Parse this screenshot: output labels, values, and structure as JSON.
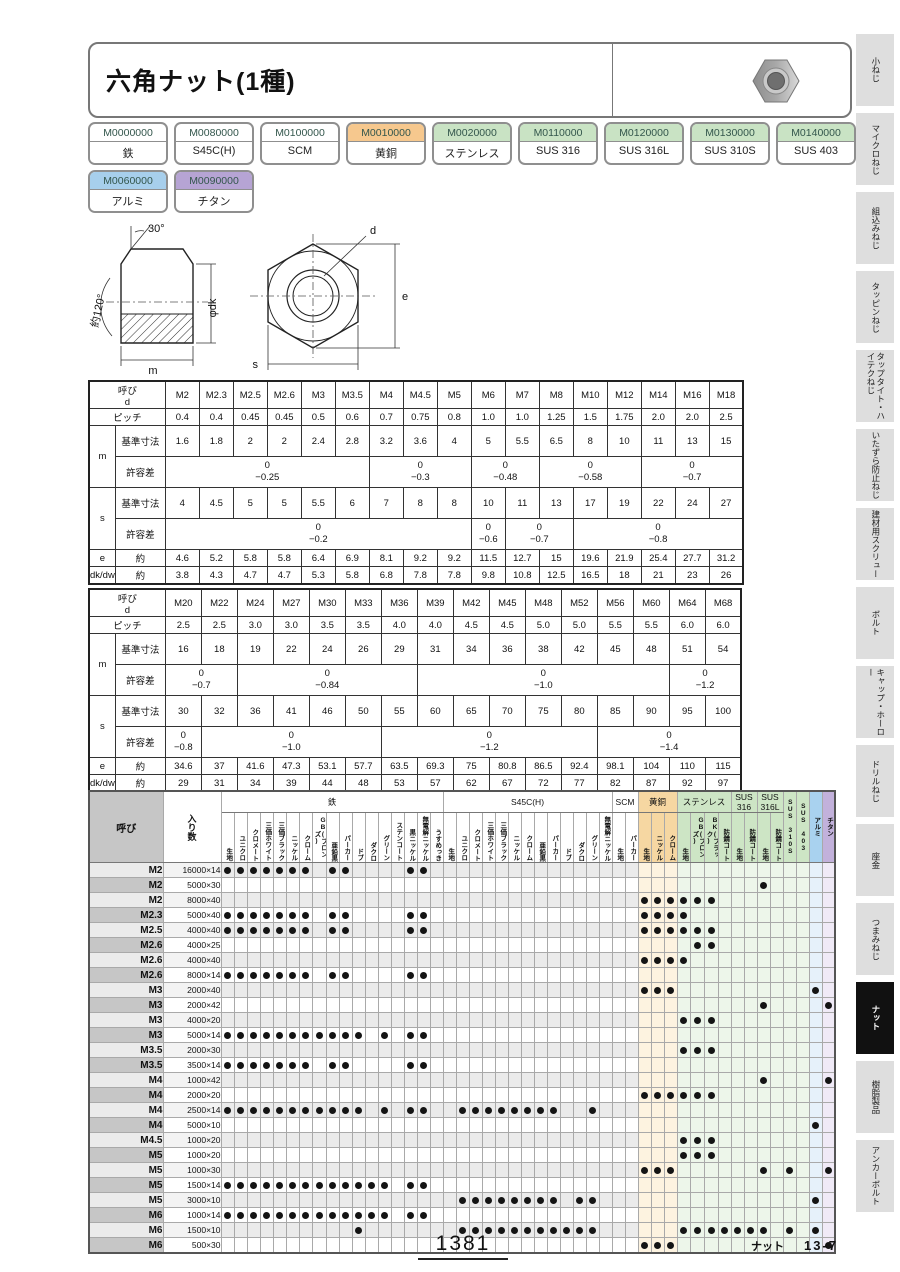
{
  "page": {
    "title": "六角ナット(1種)",
    "page_number": "1381",
    "footer_category": "ナット",
    "footer_ref": "13-7"
  },
  "chips": [
    {
      "code": "M0000000",
      "label": "鉄",
      "color": "white"
    },
    {
      "code": "M0080000",
      "label": "S45C(H)",
      "color": "white"
    },
    {
      "code": "M0100000",
      "label": "SCM",
      "color": "white"
    },
    {
      "code": "M0010000",
      "label": "黄銅",
      "color": "orange"
    },
    {
      "code": "M0020000",
      "label": "ステンレス",
      "color": "green"
    },
    {
      "code": "M0110000",
      "label": "SUS 316",
      "color": "green"
    },
    {
      "code": "M0120000",
      "label": "SUS 316L",
      "color": "green"
    },
    {
      "code": "M0130000",
      "label": "SUS 310S",
      "color": "green"
    },
    {
      "code": "M0140000",
      "label": "SUS 403",
      "color": "green"
    },
    {
      "code": "M0060000",
      "label": "アルミ",
      "color": "blue"
    },
    {
      "code": "M0090000",
      "label": "チタン",
      "color": "purple"
    }
  ],
  "drawing": {
    "labels": {
      "angle_top": "30°",
      "angle_left": "約120°",
      "m": "m",
      "dk": "φdk",
      "d": "d",
      "e": "e",
      "s": "s"
    }
  },
  "dim_labels": {
    "head": "呼び",
    "head_sub": "d",
    "pitch": "ピッチ",
    "m": "m",
    "s": "s",
    "basic": "基準寸法",
    "tol": "許容差",
    "e": "e",
    "dk": "dk/dw",
    "approx": "約"
  },
  "dim_tables": [
    {
      "cols": [
        "M2",
        "M2.3",
        "M2.5",
        "M2.6",
        "M3",
        "M3.5",
        "M4",
        "M4.5",
        "M5",
        "M6",
        "M7",
        "M8",
        "M10",
        "M12",
        "M14",
        "M16",
        "M18"
      ],
      "pitch": [
        "0.4",
        "0.4",
        "0.45",
        "0.45",
        "0.5",
        "0.6",
        "0.7",
        "0.75",
        "0.8",
        "1.0",
        "1.0",
        "1.25",
        "1.5",
        "1.75",
        "2.0",
        "2.0",
        "2.5"
      ],
      "m_basic": [
        "1.6",
        "1.8",
        "2",
        "2",
        "2.4",
        "2.8",
        "3.2",
        "3.6",
        "4",
        "5",
        "5.5",
        "6.5",
        "8",
        "10",
        "11",
        "13",
        "15"
      ],
      "m_tol": [
        {
          "top": "0",
          "bottom": "−0.25",
          "span": 6
        },
        {
          "top": "0",
          "bottom": "−0.3",
          "span": 3
        },
        {
          "top": "0",
          "bottom": "−0.48",
          "span": 2
        },
        {
          "top": "0",
          "bottom": "−0.58",
          "span": 3
        },
        {
          "top": "0",
          "bottom": "−0.7",
          "span": 3
        }
      ],
      "s_basic": [
        "4",
        "4.5",
        "5",
        "5",
        "5.5",
        "6",
        "7",
        "8",
        "8",
        "10",
        "11",
        "13",
        "17",
        "19",
        "22",
        "24",
        "27"
      ],
      "s_tol": [
        {
          "top": "0",
          "bottom": "−0.2",
          "span": 9
        },
        {
          "top": "0",
          "bottom": "−0.6",
          "span": 1
        },
        {
          "top": "0",
          "bottom": "−0.7",
          "span": 2
        },
        {
          "top": "0",
          "bottom": "−0.8",
          "span": 5
        }
      ],
      "e": [
        "4.6",
        "5.2",
        "5.8",
        "5.8",
        "6.4",
        "6.9",
        "8.1",
        "9.2",
        "9.2",
        "11.5",
        "12.7",
        "15",
        "19.6",
        "21.9",
        "25.4",
        "27.7",
        "31.2"
      ],
      "dk": [
        "3.8",
        "4.3",
        "4.7",
        "4.7",
        "5.3",
        "5.8",
        "6.8",
        "7.8",
        "7.8",
        "9.8",
        "10.8",
        "12.5",
        "16.5",
        "18",
        "21",
        "23",
        "26"
      ]
    },
    {
      "cols": [
        "M20",
        "M22",
        "M24",
        "M27",
        "M30",
        "M33",
        "M36",
        "M39",
        "M42",
        "M45",
        "M48",
        "M52",
        "M56",
        "M60",
        "M64",
        "M68"
      ],
      "pitch": [
        "2.5",
        "2.5",
        "3.0",
        "3.0",
        "3.5",
        "3.5",
        "4.0",
        "4.0",
        "4.5",
        "4.5",
        "5.0",
        "5.0",
        "5.5",
        "5.5",
        "6.0",
        "6.0"
      ],
      "m_basic": [
        "16",
        "18",
        "19",
        "22",
        "24",
        "26",
        "29",
        "31",
        "34",
        "36",
        "38",
        "42",
        "45",
        "48",
        "51",
        "54"
      ],
      "m_tol": [
        {
          "top": "0",
          "bottom": "−0.7",
          "span": 2
        },
        {
          "top": "0",
          "bottom": "−0.84",
          "span": 5
        },
        {
          "top": "0",
          "bottom": "−1.0",
          "span": 7
        },
        {
          "top": "0",
          "bottom": "−1.2",
          "span": 2
        }
      ],
      "s_basic": [
        "30",
        "32",
        "36",
        "41",
        "46",
        "50",
        "55",
        "60",
        "65",
        "70",
        "75",
        "80",
        "85",
        "90",
        "95",
        "100"
      ],
      "s_tol": [
        {
          "top": "0",
          "bottom": "−0.8",
          "span": 1
        },
        {
          "top": "0",
          "bottom": "−1.0",
          "span": 5
        },
        {
          "top": "0",
          "bottom": "−1.2",
          "span": 6
        },
        {
          "top": "0",
          "bottom": "−1.4",
          "span": 4
        }
      ],
      "e": [
        "34.6",
        "37",
        "41.6",
        "47.3",
        "53.1",
        "57.7",
        "63.5",
        "69.3",
        "75",
        "80.8",
        "86.5",
        "92.4",
        "98.1",
        "104",
        "110",
        "115"
      ],
      "dk": [
        "29",
        "31",
        "34",
        "39",
        "44",
        "48",
        "53",
        "57",
        "62",
        "67",
        "72",
        "77",
        "82",
        "87",
        "92",
        "97"
      ]
    }
  ],
  "matrix": {
    "size_header": "呼び",
    "qty_header": "入り数",
    "groups": [
      {
        "label": "鉄",
        "tint": "iron",
        "cols": [
          "生地",
          "ユニクロ",
          "クロメート",
          "三価ホワイト",
          "三価ブラック",
          "ニッケル",
          "クローム",
          "GB(ブロンズ)",
          "亜鉛黒",
          "パーカー",
          "ドブ",
          "ダクロ",
          "グリーン",
          "ステンコート",
          "黒ニッケル",
          "無電解ニッケル",
          "うすめっき"
        ]
      },
      {
        "label": "S45C(H)",
        "tint": "iron",
        "cols": [
          "生地",
          "ユニクロ",
          "クロメート",
          "三価ホワイト",
          "三価ブラック",
          "ニッケル",
          "クローム",
          "亜鉛黒",
          "パーカー",
          "ドブ",
          "ダクロ",
          "グリーン",
          "無電解ニッケル"
        ]
      },
      {
        "label": "SCM",
        "tint": "iron",
        "cols": [
          "生地",
          "パーカー"
        ]
      },
      {
        "label": "黄銅",
        "tint": "brass",
        "cols": [
          "生地",
          "ニッケル",
          "クローム"
        ]
      },
      {
        "label": "ステンレス",
        "tint": "sus",
        "cols": [
          "生地",
          "GB(ブロンズ)",
          "BK(ブラック)",
          "防錆コート"
        ]
      },
      {
        "label": "SUS 316",
        "tint": "sus",
        "cols": [
          "生地",
          "防錆コート"
        ]
      },
      {
        "label": "SUS 316L",
        "tint": "sus",
        "cols": [
          "生地",
          "防錆コート"
        ]
      },
      {
        "label": "SUS 310S",
        "tint": "sus",
        "cols": []
      },
      {
        "label": "SUS 403",
        "tint": "sus",
        "cols": []
      },
      {
        "label": "アルミ",
        "tint": "alm",
        "cols": []
      },
      {
        "label": "チタン",
        "tint": "tit",
        "cols": []
      }
    ],
    "rows": [
      {
        "size": "M2",
        "qty": "16000×14",
        "dots": [
          1,
          2,
          3,
          4,
          5,
          6,
          7,
          9,
          10,
          15,
          16
        ]
      },
      {
        "size": "M2",
        "qty": "5000×30",
        "dots": [
          42
        ]
      },
      {
        "size": "M2",
        "qty": "8000×40",
        "dots": [
          33,
          34,
          35,
          36,
          37,
          38
        ]
      },
      {
        "size": "M2.3",
        "qty": "5000×40",
        "dots": [
          1,
          2,
          3,
          4,
          5,
          6,
          7,
          9,
          10,
          15,
          16,
          33,
          34,
          35,
          36
        ]
      },
      {
        "size": "M2.5",
        "qty": "4000×40",
        "dots": [
          1,
          2,
          3,
          4,
          5,
          6,
          7,
          9,
          10,
          15,
          16,
          33,
          34,
          35,
          36,
          37,
          38
        ]
      },
      {
        "size": "M2.6",
        "qty": "4000×25",
        "dots": [
          37,
          38
        ]
      },
      {
        "size": "M2.6",
        "qty": "4000×40",
        "dots": [
          33,
          34,
          35,
          36
        ]
      },
      {
        "size": "M2.6",
        "qty": "8000×14",
        "dots": [
          1,
          2,
          3,
          4,
          5,
          6,
          7,
          9,
          10,
          15,
          16
        ]
      },
      {
        "size": "M3",
        "qty": "2000×40",
        "dots": [
          33,
          34,
          35,
          46
        ]
      },
      {
        "size": "M3",
        "qty": "2000×42",
        "dots": [
          42,
          47
        ]
      },
      {
        "size": "M3",
        "qty": "4000×20",
        "dots": [
          36,
          37,
          38
        ]
      },
      {
        "size": "M3",
        "qty": "5000×14",
        "dots": [
          1,
          2,
          3,
          4,
          5,
          6,
          7,
          8,
          9,
          10,
          11,
          13,
          15,
          16
        ]
      },
      {
        "size": "M3.5",
        "qty": "2000×30",
        "dots": [
          36,
          37,
          38
        ]
      },
      {
        "size": "M3.5",
        "qty": "3500×14",
        "dots": [
          1,
          2,
          3,
          4,
          5,
          6,
          7,
          9,
          10,
          15,
          16
        ]
      },
      {
        "size": "M4",
        "qty": "1000×42",
        "dots": [
          42,
          47
        ]
      },
      {
        "size": "M4",
        "qty": "2000×20",
        "dots": [
          33,
          34,
          35,
          36,
          37,
          38
        ]
      },
      {
        "size": "M4",
        "qty": "2500×14",
        "dots": [
          1,
          2,
          3,
          4,
          5,
          6,
          7,
          8,
          9,
          10,
          11,
          13,
          15,
          16,
          19,
          20,
          21,
          22,
          23,
          24,
          25,
          26,
          29
        ]
      },
      {
        "size": "M4",
        "qty": "5000×10",
        "dots": [
          46
        ]
      },
      {
        "size": "M4.5",
        "qty": "1000×20",
        "dots": [
          36,
          37,
          38
        ]
      },
      {
        "size": "M5",
        "qty": "1000×20",
        "dots": [
          36,
          37,
          38
        ]
      },
      {
        "size": "M5",
        "qty": "1000×30",
        "dots": [
          33,
          34,
          35,
          42,
          44,
          47
        ]
      },
      {
        "size": "M5",
        "qty": "1500×14",
        "dots": [
          1,
          2,
          3,
          4,
          5,
          6,
          7,
          8,
          9,
          10,
          11,
          12,
          13,
          15,
          16
        ]
      },
      {
        "size": "M5",
        "qty": "3000×10",
        "dots": [
          19,
          20,
          21,
          22,
          23,
          24,
          25,
          26,
          28,
          29,
          46
        ]
      },
      {
        "size": "M6",
        "qty": "1000×14",
        "dots": [
          1,
          2,
          3,
          4,
          5,
          6,
          7,
          8,
          9,
          10,
          11,
          12,
          13,
          15,
          16
        ]
      },
      {
        "size": "M6",
        "qty": "1500×10",
        "dots": [
          11,
          19,
          20,
          21,
          22,
          23,
          24,
          25,
          26,
          27,
          28,
          29,
          36,
          37,
          38,
          39,
          40,
          41,
          42,
          44,
          46
        ]
      },
      {
        "size": "M6",
        "qty": "500×30",
        "dots": [
          33,
          34,
          35,
          47
        ]
      }
    ]
  },
  "sidebar": [
    {
      "label": "小ねじ"
    },
    {
      "label": "マイクロねじ"
    },
    {
      "label": "組込みねじ"
    },
    {
      "label": "タッピンねじ"
    },
    {
      "label": "タップタイト・ハイテクねじ"
    },
    {
      "label": "いたずら防止ねじ"
    },
    {
      "label": "建材用スクリュー"
    },
    {
      "label": "ボルト"
    },
    {
      "label": "キャップ・ホーロー"
    },
    {
      "label": "ドリルねじ"
    },
    {
      "label": "座金"
    },
    {
      "label": "つまみねじ"
    },
    {
      "label": "ナット",
      "active": true
    },
    {
      "label": "樹脂製品"
    },
    {
      "label": "アンカーボルト"
    }
  ]
}
